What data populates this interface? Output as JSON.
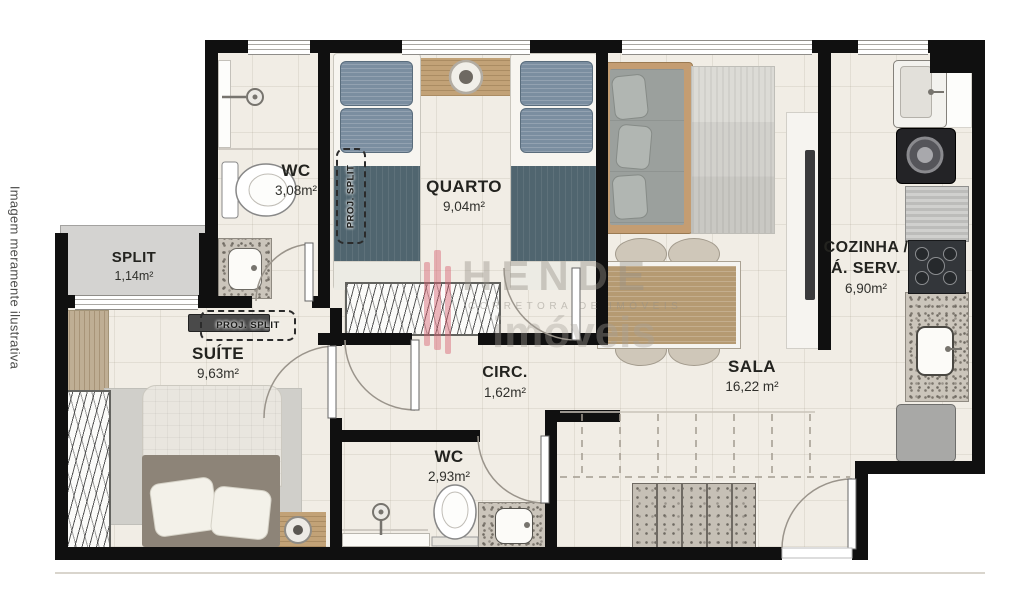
{
  "disclaimer": "Imagem meramente ilustrativa",
  "watermark": {
    "brand": "HENDE",
    "tagline": "CORRETORA DE IMÓVEIS",
    "word": "imóveis"
  },
  "rooms": [
    {
      "name": "WC",
      "area": "3,08m²"
    },
    {
      "name": "SPLIT",
      "area": "1,14m²"
    },
    {
      "name": "QUARTO",
      "area": "9,04m²"
    },
    {
      "name": "SUÍTE",
      "area": "9,63m²"
    },
    {
      "name": "CIRC.",
      "area": "1,62m²"
    },
    {
      "name": "WC",
      "area": "2,93m²"
    },
    {
      "name": "SALA",
      "area": "16,22 m²"
    },
    {
      "name": "COZINHA /",
      "name2": "Á. SERV.",
      "area": "6,90m²"
    }
  ],
  "annotations": {
    "proj_split": "PROJ. SPLIT"
  },
  "colors": {
    "wall": "#101010",
    "floor": "#f1ede5",
    "granite": "#cbc5bb",
    "wood": "#c2a277",
    "accent_logo": "#d6606e",
    "bed_blue": "#7b8ea0"
  }
}
